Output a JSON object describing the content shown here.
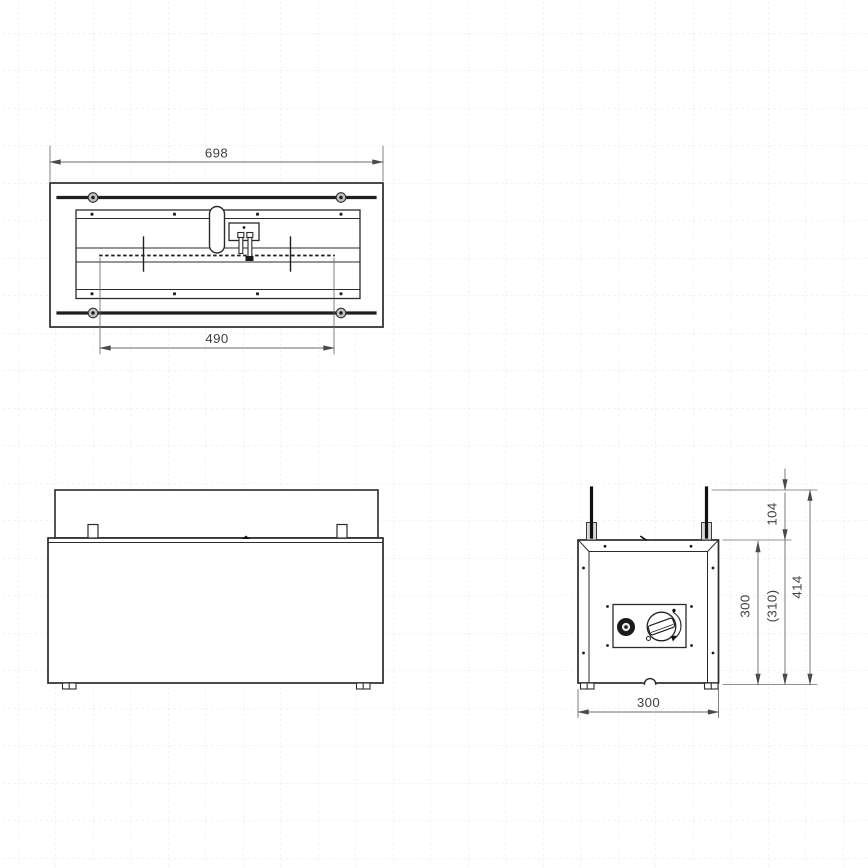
{
  "drawing": {
    "dims": {
      "overall_width": "698",
      "burner_length": "490",
      "rod_height": "104",
      "body_height": "300",
      "body_height_ref": "(310)",
      "overall_height": "414",
      "base_depth": "300"
    },
    "colors": {
      "line": "#2b2b2b",
      "dimension": "#6b6b6b",
      "text": "#3f3f3f",
      "grid": "#e4e4e4",
      "background": "#ffffff"
    }
  }
}
